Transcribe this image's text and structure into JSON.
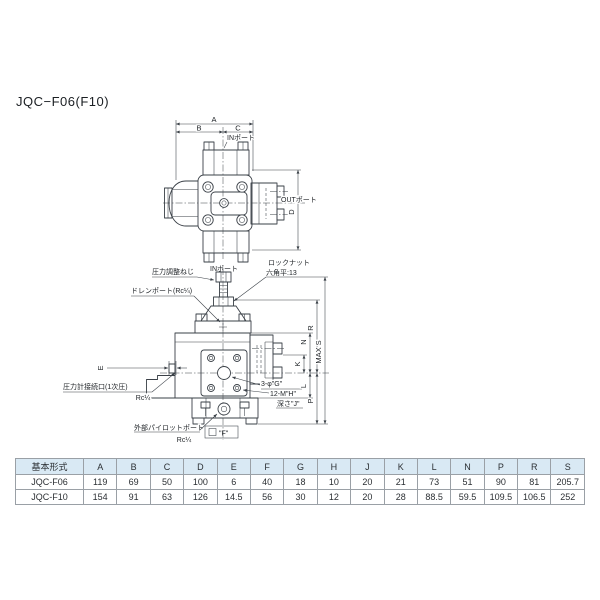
{
  "title": "JQC−F06(F10)",
  "colors": {
    "line": "#3a4047",
    "table_header_bg": "#d9e9f4",
    "table_border": "#9aa0a6"
  },
  "top_view": {
    "dim_a": "A",
    "dim_b": "B",
    "dim_c": "C",
    "dim_d": "D",
    "in_port_top": "INポート",
    "in_port_bottom": "INポート",
    "out_port": "OUTポート"
  },
  "front_view": {
    "adjust_screw": "圧力調整ねじ",
    "lock_nut": "ロックナット",
    "hex_flat": "六角平:13",
    "drain_port": "ドレンポート(Rc¼)",
    "gauge_port": "圧力計接続口(1次圧)",
    "gauge_port_size": "Rc¼",
    "pilot_port": "外部パイロットポート",
    "pilot_port_size": "Rc¼",
    "holes_g": "3-φ\"G\"",
    "threads_h": "12-M\"H\"",
    "depth_j": "深さ\"J\"",
    "square_f": "\"F\"",
    "dim_e": "E",
    "dim_k": "K",
    "dim_n": "N",
    "dim_r": "R",
    "dim_l": "L",
    "dim_p": "P",
    "dim_max_s": "MAX S"
  },
  "table": {
    "headers": [
      "基本形式",
      "A",
      "B",
      "C",
      "D",
      "E",
      "F",
      "G",
      "H",
      "J",
      "K",
      "L",
      "N",
      "P",
      "R",
      "S"
    ],
    "rows": [
      [
        "JQC-F06",
        "119",
        "69",
        "50",
        "100",
        "6",
        "40",
        "18",
        "10",
        "20",
        "21",
        "73",
        "51",
        "90",
        "81",
        "205.7"
      ],
      [
        "JQC-F10",
        "154",
        "91",
        "63",
        "126",
        "14.5",
        "56",
        "30",
        "12",
        "20",
        "28",
        "88.5",
        "59.5",
        "109.5",
        "106.5",
        "252"
      ]
    ]
  }
}
